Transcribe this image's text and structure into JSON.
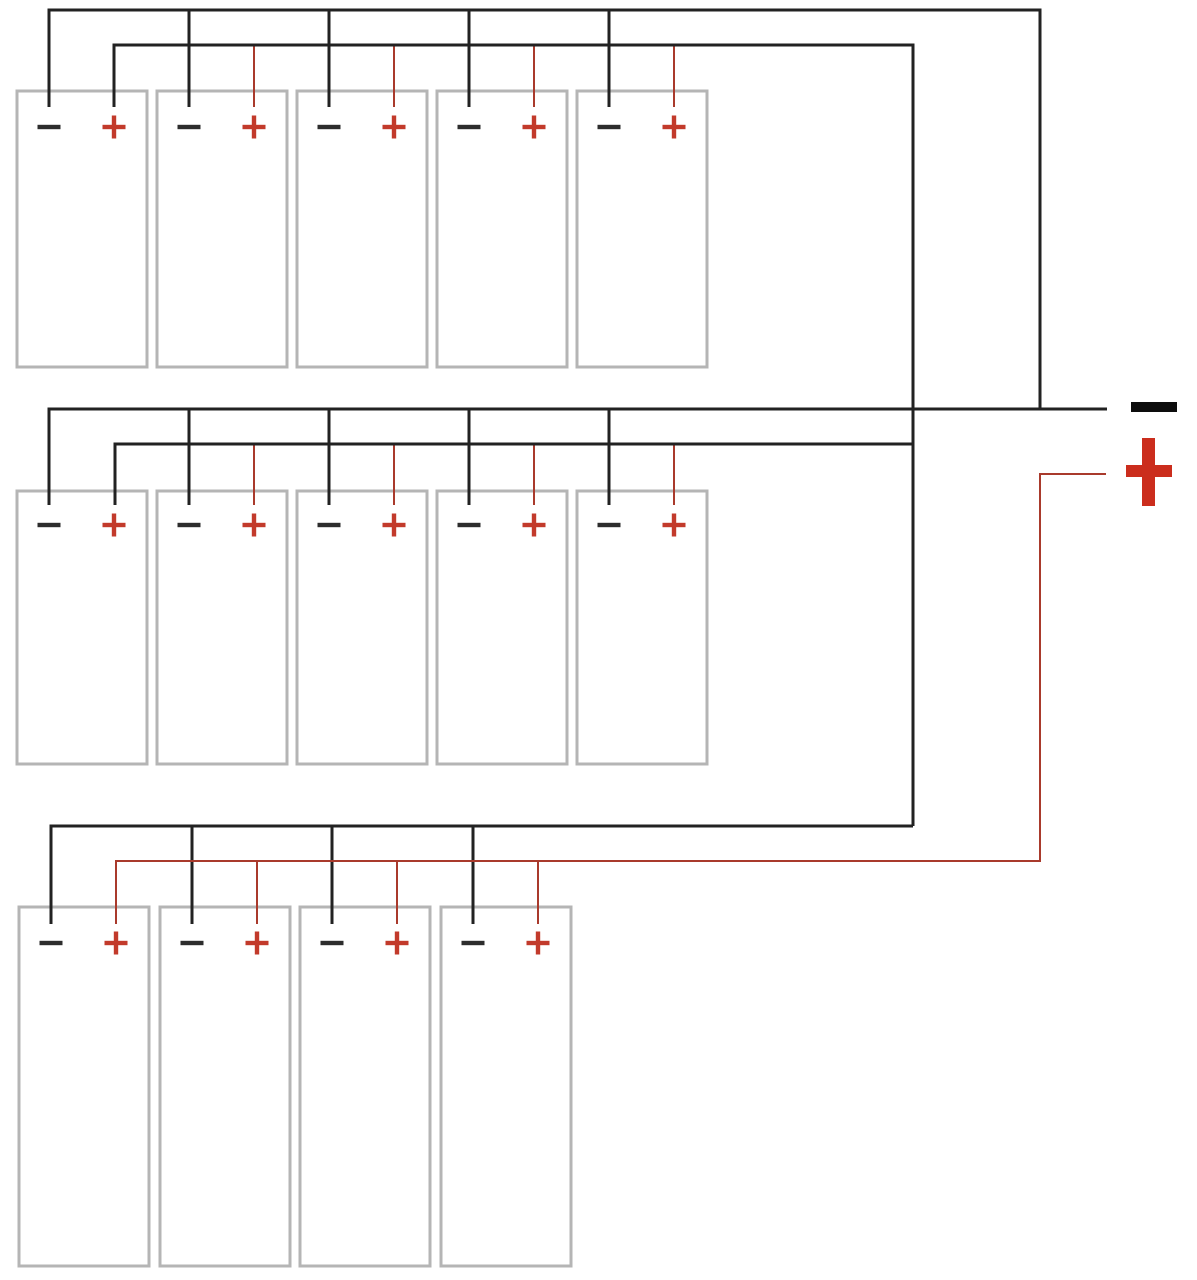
{
  "canvas": {
    "width": 1197,
    "height": 1280,
    "background": "#ffffff"
  },
  "colors": {
    "black_wire": "#222222",
    "red_wire": "#a93a2c",
    "battery_border": "#b5b5b5",
    "battery_fill": "#ffffff",
    "minus_sign": "#2d2d2d",
    "plus_sign": "#c23a2b",
    "output_minus": "#0d0d0d",
    "output_plus": "#cb2d1d"
  },
  "battery": {
    "width": 130,
    "minus_offset": 32,
    "plus_offset": 97,
    "sign_arm": 11.5,
    "sign_stroke": 4.4,
    "border_stroke": 3
  },
  "wire_stroke": {
    "black": 3,
    "red": 2
  },
  "terminals": {
    "minus_label": "−",
    "plus_label": "+"
  },
  "groups": [
    {
      "name": "parallel-group-1",
      "cell_count": 5,
      "boxes_x": [
        17,
        157,
        297,
        437,
        577
      ],
      "box_top": 91,
      "box_height": 276,
      "neg_bus_y": 10,
      "pos_bus_y": 45,
      "drop_end_y": 107,
      "sign_y": 127
    },
    {
      "name": "parallel-group-2",
      "cell_count": 5,
      "boxes_x": [
        17,
        157,
        297,
        437,
        577
      ],
      "box_top": 491,
      "box_height": 273,
      "neg_bus_y": 409,
      "pos_bus_y": 444,
      "drop_end_y": 505,
      "sign_y": 525
    },
    {
      "name": "parallel-group-3",
      "cell_count": 4,
      "boxes_x": [
        19,
        160,
        300,
        441
      ],
      "box_top": 907,
      "box_height": 359,
      "neg_bus_y": 826,
      "pos_bus_y": 861,
      "drop_end_y": 924,
      "sign_y": 943
    }
  ],
  "bus_wires": [
    {
      "name": "group1-negative-bus",
      "color": "black",
      "points": [
        [
          49,
          107
        ],
        [
          49,
          10
        ],
        [
          1040,
          10
        ],
        [
          1040,
          408
        ]
      ]
    },
    {
      "name": "group1-positive-bus",
      "color": "black",
      "points": [
        [
          114,
          107
        ],
        [
          114,
          45
        ],
        [
          913,
          45
        ],
        [
          913,
          826
        ]
      ]
    },
    {
      "name": "group2-negative-bus-to-output",
      "color": "black",
      "points": [
        [
          49,
          505
        ],
        [
          49,
          409
        ],
        [
          1107,
          409
        ]
      ]
    },
    {
      "name": "group2-positive-bus",
      "color": "black",
      "points": [
        [
          115,
          505
        ],
        [
          115,
          444
        ],
        [
          913,
          444
        ]
      ]
    },
    {
      "name": "group3-negative-bus",
      "color": "black",
      "points": [
        [
          51,
          924
        ],
        [
          51,
          826
        ],
        [
          913,
          826
        ]
      ]
    },
    {
      "name": "group3-positive-bus-to-output",
      "color": "red",
      "points": [
        [
          116,
          924
        ],
        [
          116,
          861
        ],
        [
          1040,
          861
        ],
        [
          1040,
          474
        ],
        [
          1106,
          474
        ]
      ]
    }
  ],
  "outputs": {
    "minus_label": "−",
    "plus_label": "+",
    "minus_bar": {
      "x": 1131,
      "y": 402,
      "width": 46,
      "height": 10
    },
    "plus_h_bar": {
      "x": 1126,
      "y": 465,
      "width": 46,
      "height": 12
    },
    "plus_v_bar": {
      "x": 1142,
      "y": 438,
      "width": 13,
      "height": 68
    }
  }
}
